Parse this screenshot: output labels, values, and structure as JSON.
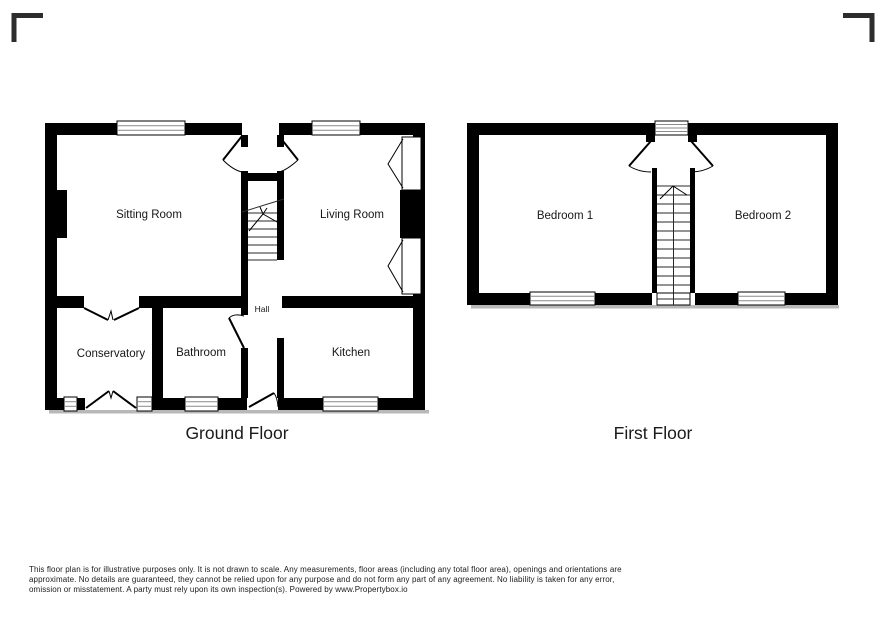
{
  "floors": {
    "ground": {
      "title": "Ground Floor",
      "rooms": {
        "sitting_room": "Sitting Room",
        "living_room": "Living Room",
        "hall": "Hall",
        "conservatory": "Conservatory",
        "bathroom": "Bathroom",
        "kitchen": "Kitchen"
      }
    },
    "first": {
      "title": "First Floor",
      "rooms": {
        "bedroom1": "Bedroom 1",
        "bedroom2": "Bedroom 2"
      }
    }
  },
  "footer": {
    "line1": "This floor plan is for illustrative purposes only. It is not drawn to scale. Any measurements, floor areas (including any total floor area), openings and orientations are",
    "line2": "approximate. No details are guaranteed, they cannot be relied upon for any purpose and do not form any part of any agreement. No liability is taken for any error,",
    "line3": "omission or misstatement. A party must rely upon its own inspection(s). Powered by www.Propertybox.io"
  },
  "colors": {
    "wall": "#000000",
    "shadow": "#b8b8b8",
    "corner_mark": "#2d2d2d"
  }
}
